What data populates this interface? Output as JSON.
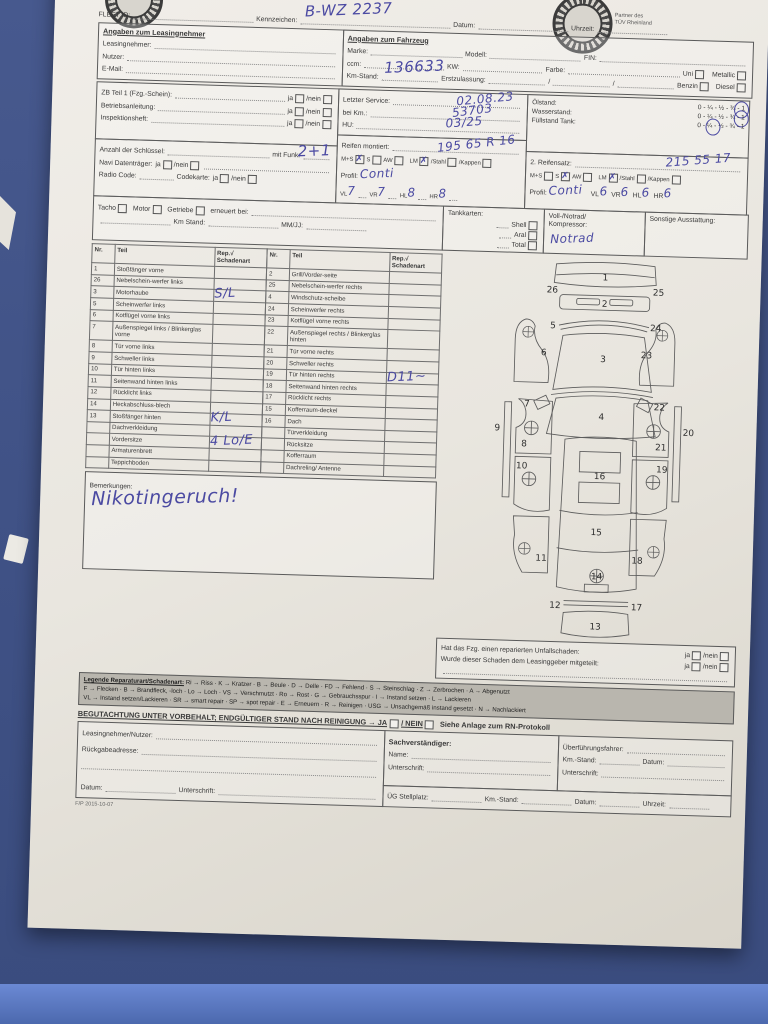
{
  "colors": {
    "background_blue": "#3F5185",
    "paper": "#E9E6DF",
    "ink": "#4B4AA2",
    "legend_gray": "#B9B6AE"
  },
  "header": {
    "fleet_id_label": "FLEET ID:",
    "kennzeichen_label": "Kennzeichen:",
    "kennzeichen_value": "B-WZ 2237",
    "datum_label": "Datum:",
    "uhrzeit_label": "Uhrzeit:"
  },
  "logos": {
    "right_caption_1": "Partner des",
    "right_caption_2": "TÜV Rheinland"
  },
  "leasing": {
    "title": "Angaben zum Leasingnehmer",
    "rows": [
      {
        "label": "Leasingnehmer:"
      },
      {
        "label": "Nutzer:"
      },
      {
        "label": "E-Mail:"
      }
    ]
  },
  "fahrzeug": {
    "title": "Angaben zum Fahrzeug",
    "marke": "Marke:",
    "modell": "Modell:",
    "fin": "FIN:",
    "ccm": "ccm:",
    "kw": "KW:",
    "farbe": "Farbe:",
    "uni": "Uni",
    "metallic": "Metallic",
    "km_stand_label": "Km-Stand:",
    "km_stand_value": "136633",
    "erstzulassung": "Erstzulassung:",
    "benzin": "Benzin",
    "diesel": "Diesel"
  },
  "docs": {
    "rows": [
      {
        "label": "ZB Teil 1 (Fzg.-Schein):"
      },
      {
        "label": "Betriebsanleitung:"
      },
      {
        "label": "Inspektionsheft:"
      }
    ],
    "ja": "ja",
    "nein": "nein"
  },
  "keys": {
    "anzahl": "Anzahl der Schlüssel:",
    "mit_funk": "mit Funk:",
    "value": "2+1",
    "navi": "Navi Datenträger:",
    "radio": "Radio Code:",
    "codekarte": "Codekarte:",
    "ja": "ja",
    "nein": "nein"
  },
  "service": {
    "letzter": "Letzter Service:",
    "letzter_value": "02.08.23",
    "bei_km": "bei Km.:",
    "bei_km_value": "53703",
    "hu": "HU:",
    "hu_value": "03/25"
  },
  "tyres1": {
    "label": "Reifen montiert:",
    "size": "195 65 R 16",
    "ms": "M+S",
    "s": "S",
    "aw": "AW",
    "lm": "LM",
    "stahl": "Stahl",
    "kappen": "Kappen",
    "profil": "Profil:",
    "profil_value": "Conti",
    "vl": "VL",
    "vr": "VR",
    "hl": "HL",
    "hr": "HR",
    "d_vl": "7",
    "d_vr": "7",
    "d_hl": "8",
    "d_hr": "8"
  },
  "fluids": {
    "scale": "0 - ¼ - ½ - ¾ - 1",
    "rows": [
      {
        "label": "Ölstand:"
      },
      {
        "label": "Wasserstand:"
      },
      {
        "label": "Füllstand Tank:"
      }
    ]
  },
  "tyres2": {
    "label": "2. Reifensatz:",
    "size": "215 55 17",
    "ms": "M+S",
    "s": "S",
    "aw": "AW",
    "lm": "LM",
    "stahl": "Stahl",
    "kappen": "Kappen",
    "profil": "Profil:",
    "profil_value": "Conti",
    "vl": "VL",
    "vr": "VR",
    "hl": "HL",
    "hr": "HR",
    "d_vl": "6",
    "d_vr": "6",
    "d_hl": "6",
    "d_hr": "6"
  },
  "drivetrain": {
    "tacho": "Tacho",
    "motor": "Motor",
    "getriebe": "Getriebe",
    "erneuert": "erneuert bei:",
    "km_stand": "Km Stand:",
    "mmjj": "MM/JJ:"
  },
  "tankkarten": {
    "label": "Tankkarten:",
    "options": [
      {
        "name": "Shell"
      },
      {
        "name": "Aral"
      },
      {
        "name": "Total"
      }
    ]
  },
  "spare": {
    "label1": "Voll-/Notrad/",
    "label2": "Kompressor:",
    "value": "Notrad"
  },
  "extras": {
    "label": "Sonstige Ausstattung:"
  },
  "damage": {
    "h_nr": "Nr.",
    "h_teil": "Teil",
    "h_rep": "Rep.√",
    "h_schaden": "Schadenart",
    "left": [
      {
        "nr": "1",
        "teil": "Stoßfänger vorne",
        "schaden": ""
      },
      {
        "nr": "26",
        "teil": "Nebelschein-werfer links",
        "schaden": ""
      },
      {
        "nr": "3",
        "teil": "Motorhaube",
        "schaden": "S/L"
      },
      {
        "nr": "5",
        "teil": "Scheinwerfer links",
        "schaden": ""
      },
      {
        "nr": "6",
        "teil": "Kotflügel vorne links",
        "schaden": ""
      },
      {
        "nr": "7",
        "teil": "Außenspiegel links / Blinkerglas vorne",
        "schaden": ""
      },
      {
        "nr": "8",
        "teil": "Tür vorne links",
        "schaden": ""
      },
      {
        "nr": "9",
        "teil": "Schweller links",
        "schaden": ""
      },
      {
        "nr": "10",
        "teil": "Tür hinten links",
        "schaden": ""
      },
      {
        "nr": "11",
        "teil": "Seitenwand hinten links",
        "schaden": ""
      },
      {
        "nr": "12",
        "teil": "Rücklicht links",
        "schaden": ""
      },
      {
        "nr": "14",
        "teil": "Heckabschluss-blech",
        "schaden": ""
      },
      {
        "nr": "13",
        "teil": "Stoßfänger hinten",
        "schaden": "K/L"
      },
      {
        "nr": "",
        "teil": "Dachverkleidung",
        "schaden": ""
      },
      {
        "nr": "",
        "teil": "Vordersitze",
        "schaden": "4 Lo/E"
      },
      {
        "nr": "",
        "teil": "Armaturenbrett",
        "schaden": ""
      },
      {
        "nr": "",
        "teil": "Teppichboden",
        "schaden": ""
      }
    ],
    "right": [
      {
        "nr": "2",
        "teil": "Grill/Vorder-seite",
        "schaden": ""
      },
      {
        "nr": "25",
        "teil": "Nebelschein-werfer rechts",
        "schaden": ""
      },
      {
        "nr": "4",
        "teil": "Windschutz-scheibe",
        "schaden": ""
      },
      {
        "nr": "24",
        "teil": "Scheinwerfer rechts",
        "schaden": ""
      },
      {
        "nr": "23",
        "teil": "Kotflügel vorne rechts",
        "schaden": ""
      },
      {
        "nr": "22",
        "teil": "Außenspiegel rechts / Blinkerglas hinten",
        "schaden": ""
      },
      {
        "nr": "21",
        "teil": "Tür vorne rechts",
        "schaden": ""
      },
      {
        "nr": "20",
        "teil": "Schweller rechts",
        "schaden": ""
      },
      {
        "nr": "19",
        "teil": "Tür hinten rechts",
        "schaden": "D11~"
      },
      {
        "nr": "18",
        "teil": "Seitenwand hinten rechts",
        "schaden": ""
      },
      {
        "nr": "17",
        "teil": "Rücklicht rechts",
        "schaden": ""
      },
      {
        "nr": "15",
        "teil": "Kofferraum-deckel",
        "schaden": ""
      },
      {
        "nr": "16",
        "teil": "Dach",
        "schaden": ""
      },
      {
        "nr": "",
        "teil": "Türverkleidung",
        "schaden": ""
      },
      {
        "nr": "",
        "teil": "Rücksitze",
        "schaden": ""
      },
      {
        "nr": "",
        "teil": "Kofferraum",
        "schaden": ""
      },
      {
        "nr": "",
        "teil": "Dachreling/ Antenne",
        "schaden": ""
      }
    ]
  },
  "bemerkungen": {
    "label": "Bemerkungen:",
    "value": "Nikotingeruch!"
  },
  "accident": {
    "q1": "Hat das Fzg. einen reparierten Unfallschaden:",
    "q2": "Wurde dieser Schaden dem Leasinggeber mitgeteilt:",
    "ja": "ja",
    "nein": "nein"
  },
  "legend": {
    "title": "Legende Reparaturart/Schadenart:",
    "line1": "Ri → Riss · K → Kratzer · B → Beule · D → Delle · FD → Fehlend · S → Steinschlag · Z → Zerbrochen · A → Abgenutzt",
    "line2": "F → Flecken · B → Brandfleck, -loch · Lo → Loch · VS → Verschmutzt · Ro → Rost · G → Gebrauchsspur · I → Instand setzen · L → Lackieren",
    "line3": "VL → Instand setzen/Lackieren · SR → smart repair · SP → spot repair · E → Erneuern · R → Reinigen · USG → Unsachgemäß instand gesetzt · N → Nachlackiert"
  },
  "vorbehalt": {
    "text1": "BEGUTACHTUNG UNTER VORBEHALT; ENDGÜLTIGER STAND NACH REINIGUNG → JA",
    "text2": "/ NEIN",
    "text3": "Siehe Anlage zum RN-Protokoll"
  },
  "sig": {
    "ln": "Leasingnehmer/Nutzer:",
    "adresse": "Rückgabeadresse:",
    "datum": "Datum:",
    "unterschrift": "Unterschrift:",
    "sv_title": "Sachverständiger:",
    "name": "Name:",
    "sv_unterschrift": "Unterschrift:",
    "uef": "Überführungsfahrer:",
    "km": "Km.-Stand:",
    "uef_datum": "Datum:",
    "uef_unterschrift": "Unterschrift:",
    "ueg": "ÜG Stellplatz:",
    "ueg_km": "Km.-Stand:",
    "ueg_datum": "Datum:",
    "uhrzeit": "Uhrzeit:"
  },
  "footer": {
    "code": "F/P 2015-10-07"
  },
  "diagram": {
    "labels": [
      {
        "n": "1",
        "x": 150,
        "y": 26
      },
      {
        "n": "26",
        "x": 88,
        "y": 42
      },
      {
        "n": "25",
        "x": 213,
        "y": 42
      },
      {
        "n": "2",
        "x": 150,
        "y": 57
      },
      {
        "n": "5",
        "x": 90,
        "y": 84
      },
      {
        "n": "24",
        "x": 211,
        "y": 84
      },
      {
        "n": "3",
        "x": 150,
        "y": 122
      },
      {
        "n": "6",
        "x": 80,
        "y": 116
      },
      {
        "n": "23",
        "x": 201,
        "y": 116
      },
      {
        "n": "7",
        "x": 62,
        "y": 177
      },
      {
        "n": "22",
        "x": 218,
        "y": 177
      },
      {
        "n": "4",
        "x": 150,
        "y": 190
      },
      {
        "n": "8",
        "x": 60,
        "y": 224
      },
      {
        "n": "21",
        "x": 221,
        "y": 224
      },
      {
        "n": "9",
        "x": 28,
        "y": 206
      },
      {
        "n": "20",
        "x": 253,
        "y": 206
      },
      {
        "n": "10",
        "x": 58,
        "y": 250
      },
      {
        "n": "19",
        "x": 223,
        "y": 250
      },
      {
        "n": "16",
        "x": 150,
        "y": 260
      },
      {
        "n": "11",
        "x": 84,
        "y": 358
      },
      {
        "n": "18",
        "x": 197,
        "y": 358
      },
      {
        "n": "15",
        "x": 148,
        "y": 326
      },
      {
        "n": "14",
        "x": 150,
        "y": 378
      },
      {
        "n": "12",
        "x": 102,
        "y": 413
      },
      {
        "n": "17",
        "x": 198,
        "y": 413
      },
      {
        "n": "13",
        "x": 150,
        "y": 437
      }
    ]
  }
}
